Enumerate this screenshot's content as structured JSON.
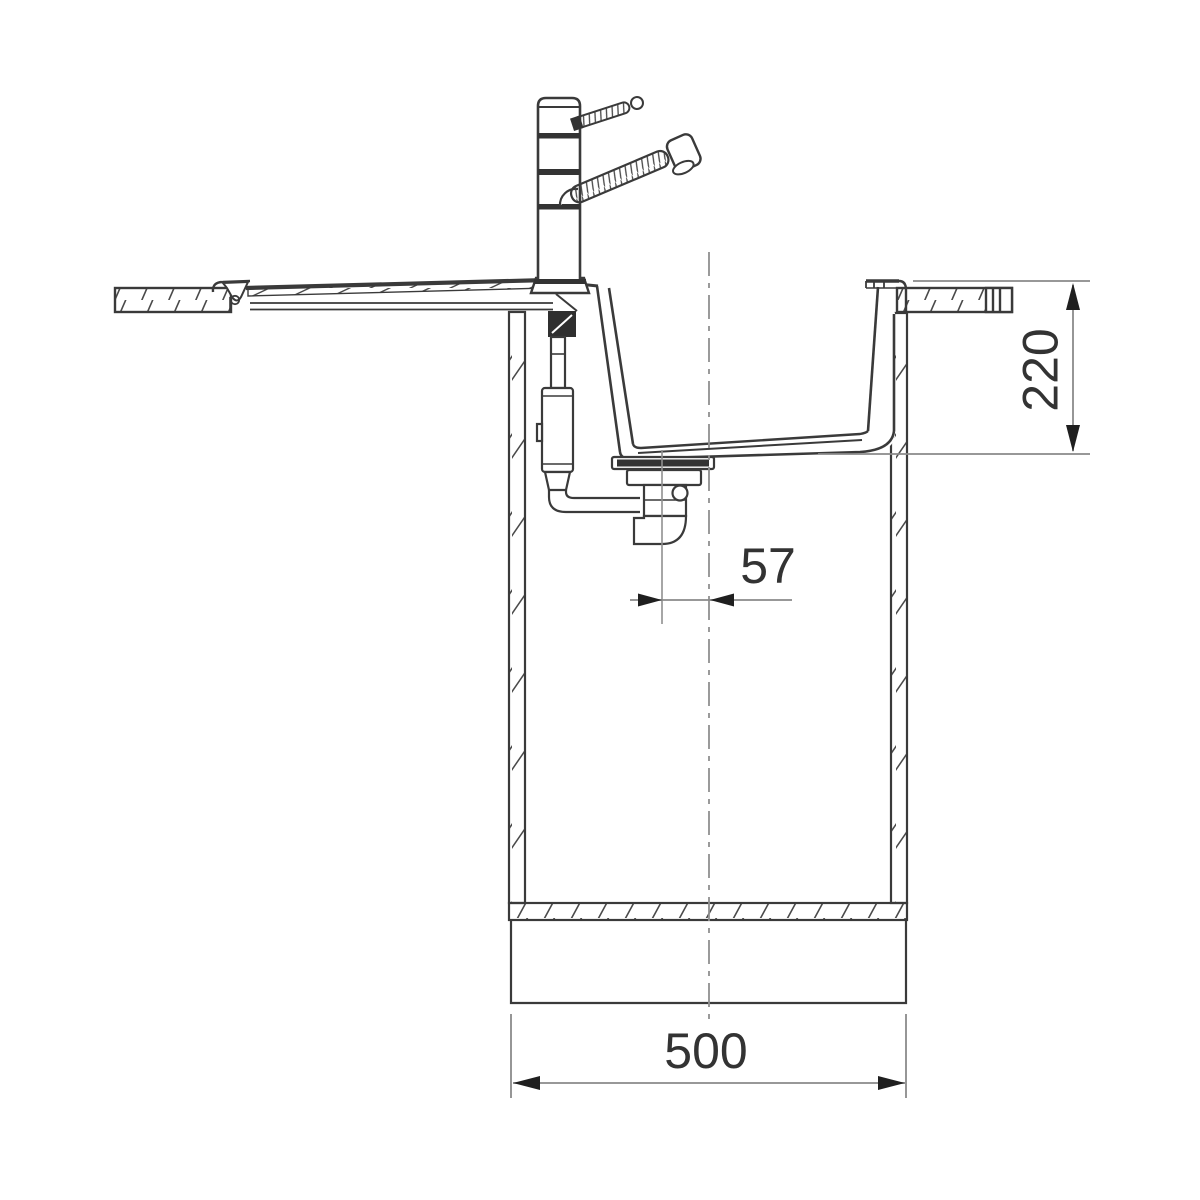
{
  "drawing": {
    "labels": {
      "depth": "220",
      "drain_offset": "57",
      "width": "500"
    },
    "colors": {
      "background": "#ffffff",
      "line": "#3a3a3a",
      "hatch": "#4a4a4a",
      "dimension_line": "#8a8a8a",
      "arrowhead": "#1f1f1f",
      "text": "#333333",
      "centerline": "#909090"
    }
  }
}
